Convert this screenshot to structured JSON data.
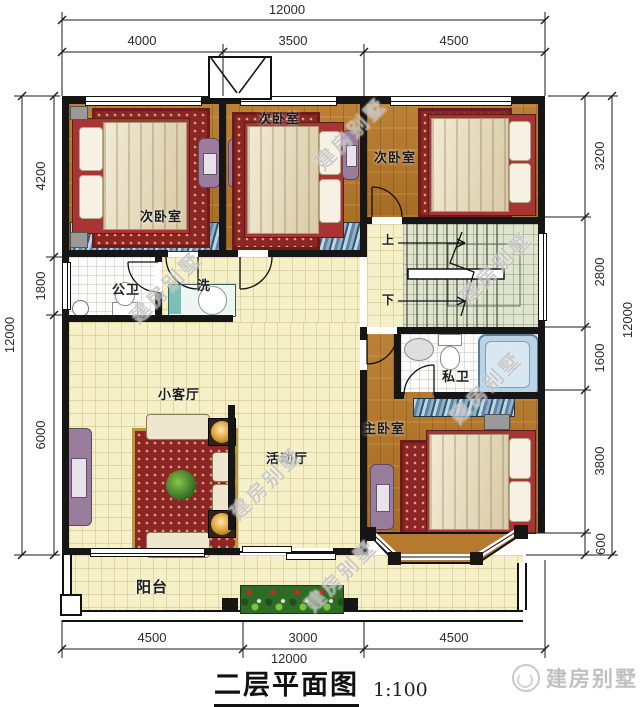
{
  "title": {
    "text": "二层平面图",
    "scale": "1:100"
  },
  "brand": {
    "logo_text": "建房别墅"
  },
  "watermark": {
    "text": "建房别墅"
  },
  "dimensions": {
    "top": {
      "total": "12000",
      "segments": [
        "4000",
        "3500",
        "4500"
      ]
    },
    "bottom": {
      "total": "12000",
      "segments": [
        "4500",
        "3000",
        "4500"
      ]
    },
    "left": {
      "total": "12000",
      "segments": [
        "4200",
        "1800",
        "6000"
      ]
    },
    "right": {
      "total": "12000",
      "segments": [
        "3200",
        "2800",
        "1600",
        "3800",
        "600"
      ]
    }
  },
  "rooms": {
    "bedroom_top_left": "次卧室",
    "bedroom_top_middle": "次卧室",
    "bedroom_top_right": "次卧室",
    "public_bathroom": "公卫",
    "washstand": "洗",
    "small_living_room": "小客厅",
    "activity_hall": "活动厅",
    "master_bedroom": "主卧室",
    "private_bathroom": "私卫",
    "balcony": "阳台",
    "stairs_up": "上",
    "stairs_down": "下"
  },
  "colors": {
    "wall": "#161616",
    "wood_floor": "#b5792f",
    "tile_cream": "#f6f0c8",
    "tile_green": "#dfe4cd",
    "bath_white": "#fcfcfa",
    "wardrobe_blue": "#5d84a4",
    "bed_red": "#a83434",
    "furniture_purple": "#9a7d9d",
    "rug_red": "#8c2626",
    "watermark_gray": "#969696",
    "dim_text": "#2a2a2a"
  }
}
